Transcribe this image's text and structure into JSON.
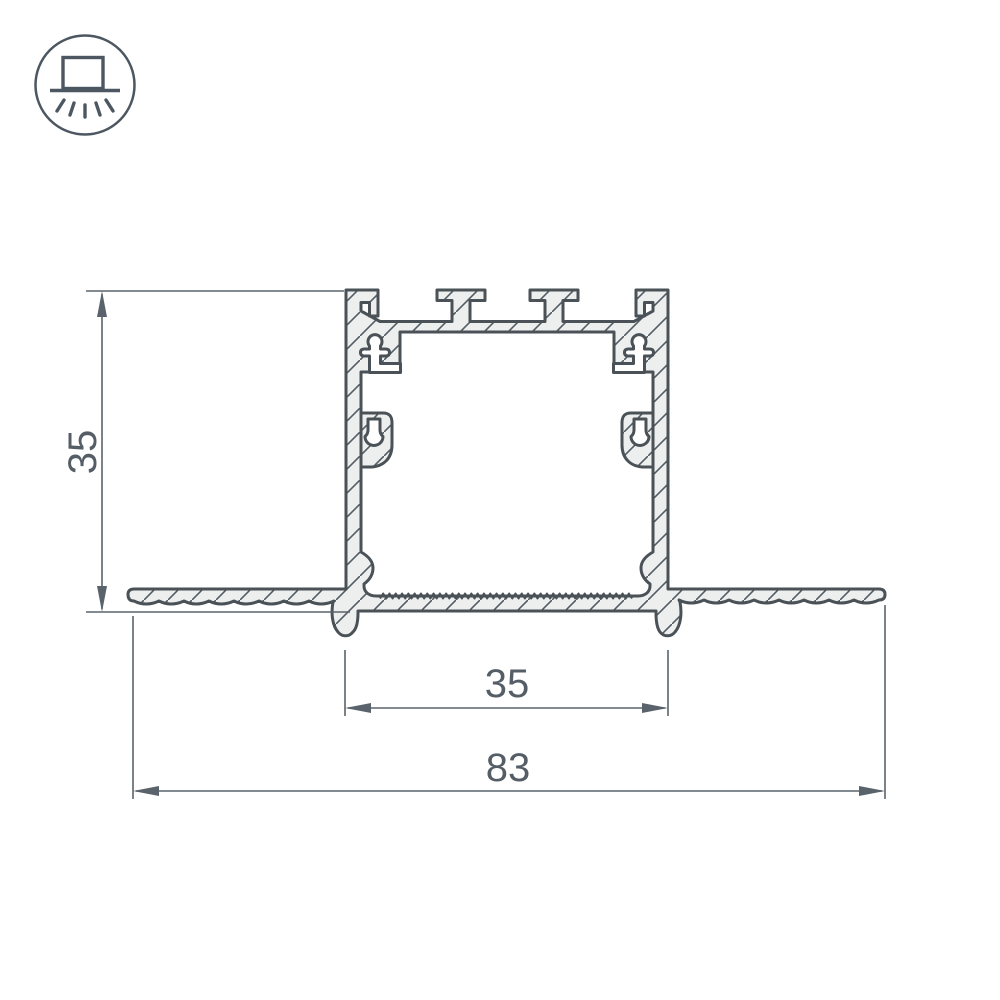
{
  "icon": {
    "name": "recessed-light-icon",
    "description": "circle containing a box recessed above a ceiling line with five light rays shining downward"
  },
  "drawing": {
    "type": "profile-cross-section",
    "subject": "recessed aluminium LED profile, sectional view with hatching",
    "dim_height": "35",
    "dim_inner_width": "35",
    "dim_outer_width": "83"
  },
  "colors": {
    "outline": "#4a5257",
    "metal_fill": "#edefef",
    "hatch_line": "#525c63",
    "dimension_line": "#5a636b",
    "label_text": "#555e66",
    "background": "#ffffff"
  }
}
